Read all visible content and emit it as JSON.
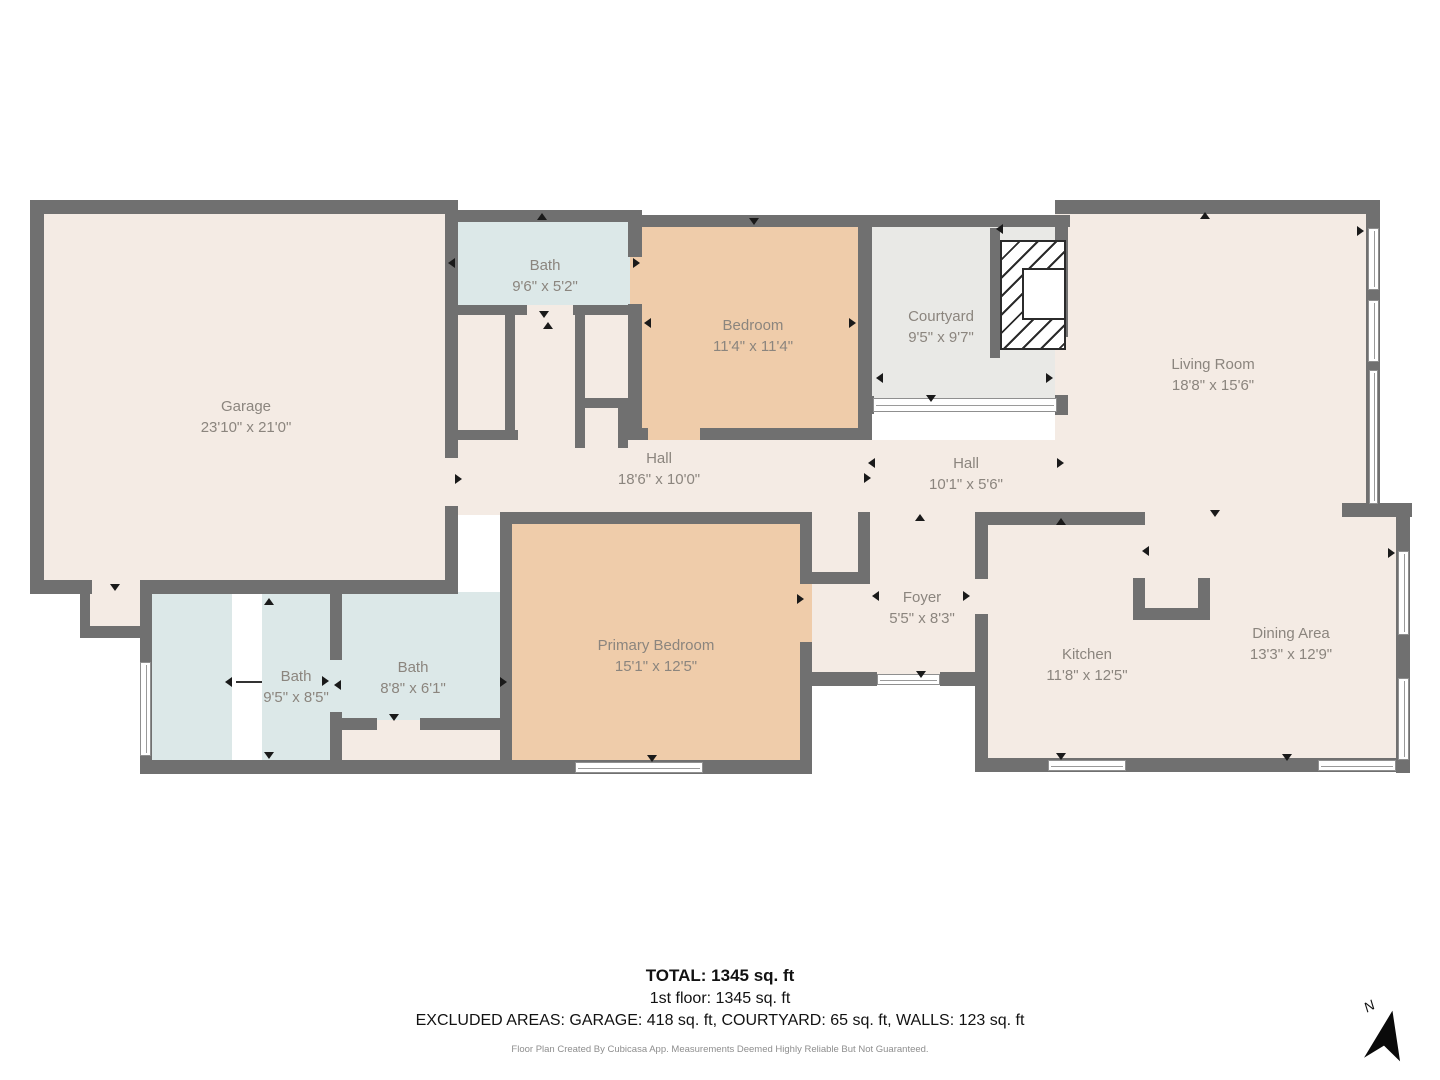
{
  "floorplan": {
    "wall_color": "#707070",
    "floor_color": "#f4ebe4",
    "bedroom_color": "#efccaa",
    "bath_color": "#dce8e8",
    "courtyard_color": "#e9e9e6",
    "rooms": [
      {
        "id": "garage",
        "name": "Garage",
        "dims": "23'10\" x 21'0\"",
        "fill": "#f4ebe4"
      },
      {
        "id": "bath-upper",
        "name": "Bath",
        "dims": "9'6\" x 5'2\"",
        "fill": "#dce8e8"
      },
      {
        "id": "bedroom",
        "name": "Bedroom",
        "dims": "11'4\" x 11'4\"",
        "fill": "#efccaa"
      },
      {
        "id": "courtyard",
        "name": "Courtyard",
        "dims": "9'5\" x 9'7\"",
        "fill": "#e9e9e6"
      },
      {
        "id": "living-room",
        "name": "Living Room",
        "dims": "18'8\" x 15'6\"",
        "fill": "#f4ebe4"
      },
      {
        "id": "hall",
        "name": "Hall",
        "dims": "18'6\" x 10'0\"",
        "fill": "#f4ebe4"
      },
      {
        "id": "hall-2",
        "name": "Hall",
        "dims": "10'1\" x 5'6\"",
        "fill": "#f4ebe4"
      },
      {
        "id": "foyer",
        "name": "Foyer",
        "dims": "5'5\" x 8'3\"",
        "fill": "#f4ebe4"
      },
      {
        "id": "primary-bedroom",
        "name": "Primary Bedroom",
        "dims": "15'1\" x 12'5\"",
        "fill": "#efccaa"
      },
      {
        "id": "bath-left",
        "name": "Bath",
        "dims": "9'5\" x 8'5\"",
        "fill": "#dce8e8"
      },
      {
        "id": "bath-mid",
        "name": "Bath",
        "dims": "8'8\" x 6'1\"",
        "fill": "#dce8e8"
      },
      {
        "id": "kitchen",
        "name": "Kitchen",
        "dims": "11'8\" x 12'5\"",
        "fill": "#f4ebe4"
      },
      {
        "id": "dining-area",
        "name": "Dining Area",
        "dims": "13'3\" x 12'9\"",
        "fill": "#f4ebe4"
      }
    ],
    "compass": {
      "label": "N"
    }
  },
  "footer": {
    "total": "TOTAL: 1345 sq. ft",
    "first_floor": "1st floor: 1345 sq. ft",
    "excluded": "EXCLUDED AREAS: GARAGE: 418 sq. ft, COURTYARD: 65 sq. ft, WALLS: 123 sq. ft",
    "disclaimer": "Floor Plan Created By Cubicasa App. Measurements Deemed Highly Reliable But Not Guaranteed."
  }
}
